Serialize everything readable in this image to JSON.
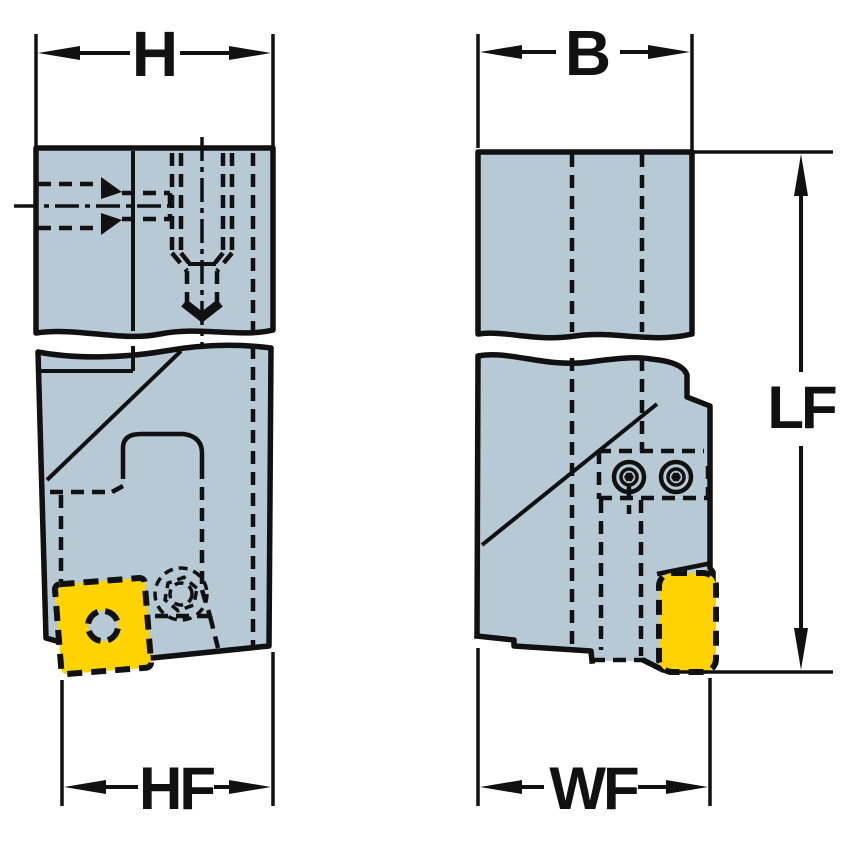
{
  "dimensions": {
    "h": {
      "label": "H"
    },
    "b": {
      "label": "B"
    },
    "lf": {
      "label": "LF"
    },
    "hf": {
      "label": "HF"
    },
    "wf": {
      "label": "WF"
    }
  },
  "colors": {
    "background": "#ffffff",
    "body": "#b7c9d5",
    "insert": "#ffd300",
    "line": "#111111"
  }
}
